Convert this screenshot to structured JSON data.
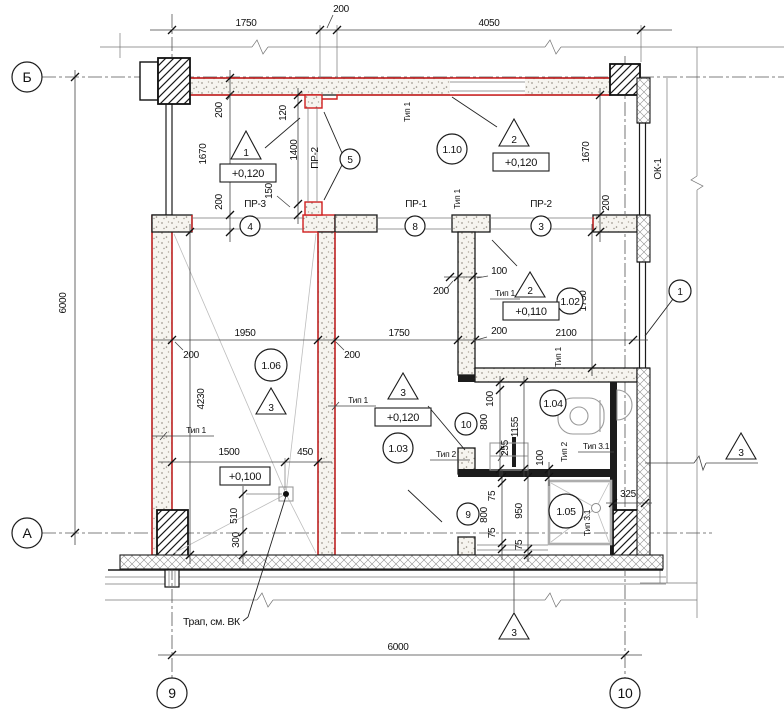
{
  "drawing": {
    "colors": {
      "highlight_wall": "#d01f1f"
    },
    "axes": {
      "b": "Б",
      "a": "А",
      "n9": "9",
      "n10": "10"
    },
    "rooms": {
      "r110": "1.10",
      "r102": "1.02",
      "r103": "1.03",
      "r104": "1.04",
      "r105": "1.05",
      "r106": "1.06"
    },
    "elevations": {
      "topleft": "+0,120",
      "r110": "+0,120",
      "r102": "+0,110",
      "r103": "+0,120",
      "r106": "+0,100"
    },
    "slope_marks": {
      "m1": "1",
      "m2_r110": "2",
      "m2_r102": "2",
      "m3_r106": "3",
      "m3_r103": "3",
      "m3_section_bottom": "3",
      "m3_section_right": "3"
    },
    "nodes": {
      "n1": "1",
      "n3": "3",
      "n4": "4",
      "n5": "5",
      "n8": "8",
      "n9": "9",
      "n10": "10"
    },
    "openings": {
      "pr1": "ПР-1",
      "pr2": "ПР-2",
      "pr2_door": "ПР-2",
      "pr3": "ПР-3",
      "ok1": "ОК-1"
    },
    "type_labels": {
      "t1_top": "Тип 1",
      "t1_mid": "Тип 1",
      "t1_r102": "Тип 1",
      "t1_bath": "Тип 1",
      "t1_left": "Тип 1",
      "t1_wallb": "Тип 1",
      "t2_door": "Тип 2",
      "t2_part": "Тип 2",
      "t31_a": "Тип 3.1",
      "t31_b": "Тип 3.1"
    },
    "note_trap": "Трап, см. ВК",
    "dims": {
      "top_1750": "1750",
      "top_200": "200",
      "top_4050": "4050",
      "left_6000": "6000",
      "bottom_6000": "6000",
      "tl_wall_200": "200",
      "tl_1670": "1670",
      "tl_wall2_200": "200",
      "door_120": "120",
      "door_1400": "1400",
      "door_150": "150",
      "tr_1670": "1670",
      "tr_200": "200",
      "mid_1950": "1950",
      "mid_200_left": "200",
      "mid_200_right": "200",
      "mid_1750": "1750",
      "mid_200_wall": "200",
      "mid_2100": "2100",
      "r106_4230": "4230",
      "r106_1500": "1500",
      "r106_450": "450",
      "r106_510": "510",
      "r106_300": "300",
      "r102_100": "100",
      "r102_200": "200",
      "r102_1750": "1750",
      "bath_100_top": "100",
      "bath_800_top": "800",
      "bath_255": "255",
      "bath_1155": "1155",
      "bath_100_mid": "100",
      "bath_75_a": "75",
      "bath_800_bot": "800",
      "bath_75_b": "75",
      "bath_950": "950",
      "bath_75_c": "75",
      "bath_325": "325"
    }
  }
}
